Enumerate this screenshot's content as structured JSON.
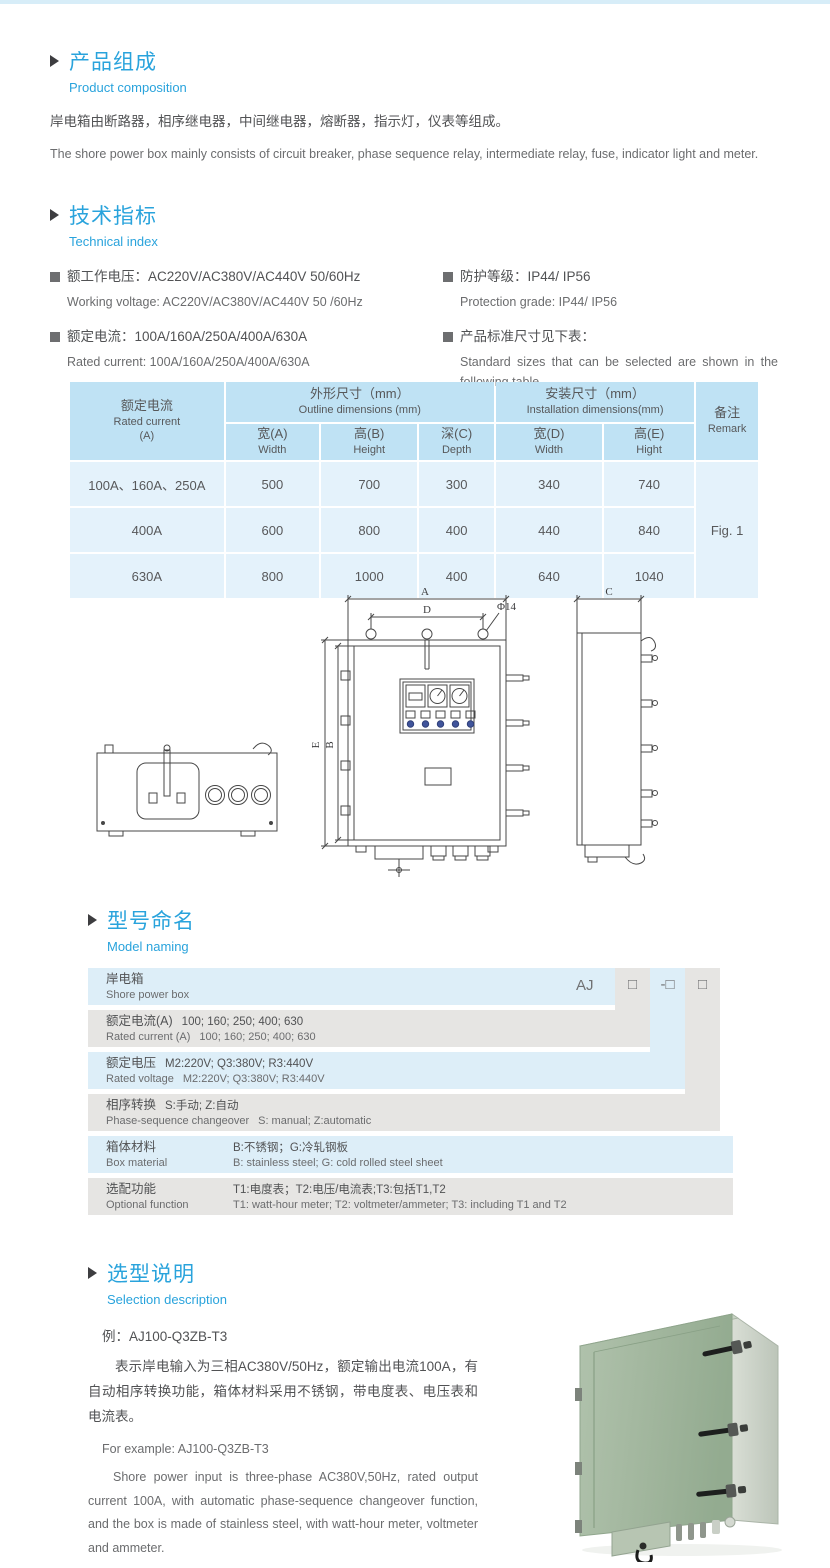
{
  "colors": {
    "accent_blue": "#29a3dc",
    "table_header_blue": "#bfe2f4",
    "table_row_blue": "#e4f2fb",
    "naming_row_blue": "#ddeef8",
    "naming_row_gray": "#e6e5e3",
    "body_text": "#5a5b5d"
  },
  "section_product": {
    "title_cn": "产品组成",
    "title_en": "Product composition",
    "body_cn": "岸电箱由断路器，相序继电器，中间继电器，熔断器，指示灯，仪表等组成。",
    "body_en": "The shore power box mainly consists of circuit breaker, phase sequence relay, intermediate relay, fuse, indicator light and meter."
  },
  "section_technical": {
    "title_cn": "技术指标",
    "title_en": "Technical index",
    "left": [
      {
        "cn": "额工作电压：AC220V/AC380V/AC440V  50/60Hz",
        "en": "Working voltage: AC220V/AC380V/AC440V 50 /60Hz"
      },
      {
        "cn": "额定电流：100A/160A/250A/400A/630A",
        "en": "Rated current: 100A/160A/250A/400A/630A"
      }
    ],
    "right": [
      {
        "cn": "防护等级：IP44/ IP56",
        "en": "Protection grade: IP44/ IP56"
      },
      {
        "cn": "产品标准尺寸见下表：",
        "en": "Standard sizes that can be selected are shown in the following table"
      }
    ]
  },
  "size_table": {
    "rated_current_cn": "额定电流",
    "rated_current_en": "Rated current",
    "rated_current_unit": "(A)",
    "outline_cn": "外形尺寸（mm）",
    "outline_en": "Outline dimensions (mm)",
    "install_cn": "安装尺寸（mm）",
    "install_en": "Installation dimensions(mm)",
    "remark_cn": "备注",
    "remark_en": "Remark",
    "sub_headers": [
      {
        "cn": "宽(A)",
        "en": "Width"
      },
      {
        "cn": "高(B)",
        "en": "Height"
      },
      {
        "cn": "深(C)",
        "en": "Depth"
      },
      {
        "cn": "宽(D)",
        "en": "Width"
      },
      {
        "cn": "高(E)",
        "en": "Hight"
      }
    ],
    "rows": [
      {
        "current": "100A、160A、250A",
        "w": "500",
        "h": "700",
        "d": "300",
        "iw": "340",
        "ih": "740"
      },
      {
        "current": "400A",
        "w": "600",
        "h": "800",
        "d": "400",
        "iw": "440",
        "ih": "840"
      },
      {
        "current": "630A",
        "w": "800",
        "h": "1000",
        "d": "400",
        "iw": "640",
        "ih": "1040"
      }
    ],
    "remark_value": "Fig. 1"
  },
  "drawing": {
    "labels": {
      "A": "A",
      "B": "B",
      "C": "C",
      "D": "D",
      "E": "E",
      "phi": "Φ14"
    }
  },
  "model_naming": {
    "title_cn": "型号命名",
    "title_en": "Model naming",
    "prefix": "AJ",
    "code_boxes": [
      "□",
      "-□",
      "□"
    ],
    "rows": [
      {
        "cn_label": "岸电箱",
        "cn_detail": "",
        "en_label": "Shore power box",
        "en_detail": ""
      },
      {
        "cn_label": "额定电流(A)",
        "cn_detail": "100; 160; 250; 400; 630",
        "en_label": "Rated current (A)",
        "en_detail": "100; 160; 250; 400; 630"
      },
      {
        "cn_label": "额定电压",
        "cn_detail": "M2:220V;  Q3:380V;  R3:440V",
        "en_label": "Rated voltage",
        "en_detail": "M2:220V;  Q3:380V;  R3:440V"
      },
      {
        "cn_label": "相序转换",
        "cn_detail": "S:手动; Z:自动",
        "en_label": "Phase-sequence changeover",
        "en_detail": "S: manual;  Z:automatic"
      },
      {
        "cn_label": "箱体材料",
        "cn_detail": "B:不锈钢；G:冷轧钢板",
        "en_label": "Box material",
        "en_detail": "B: stainless steel; G: cold rolled steel sheet"
      },
      {
        "cn_label": "选配功能",
        "cn_detail": "T1:电度表；T2:电压/电流表;T3:包括T1,T2",
        "en_label": "Optional function",
        "en_detail": "T1: watt-hour meter; T2: voltmeter/ammeter; T3: including T1 and T2"
      }
    ]
  },
  "section_selection": {
    "title_cn": "选型说明",
    "title_en": "Selection description",
    "example_cn": "例：AJ100-Q3ZB-T3",
    "body_cn": "表示岸电输入为三相AC380V/50Hz，额定输出电流100A，有自动相序转换功能，箱体材料采用不锈钢，带电度表、电压表和电流表。",
    "example_en": "For example: AJ100-Q3ZB-T3",
    "body_en": "Shore power input is three-phase AC380V,50Hz, rated output current 100A, with automatic phase-sequence changeover function, and the box is made of stainless steel, with watt-hour meter, voltmeter and ammeter."
  }
}
